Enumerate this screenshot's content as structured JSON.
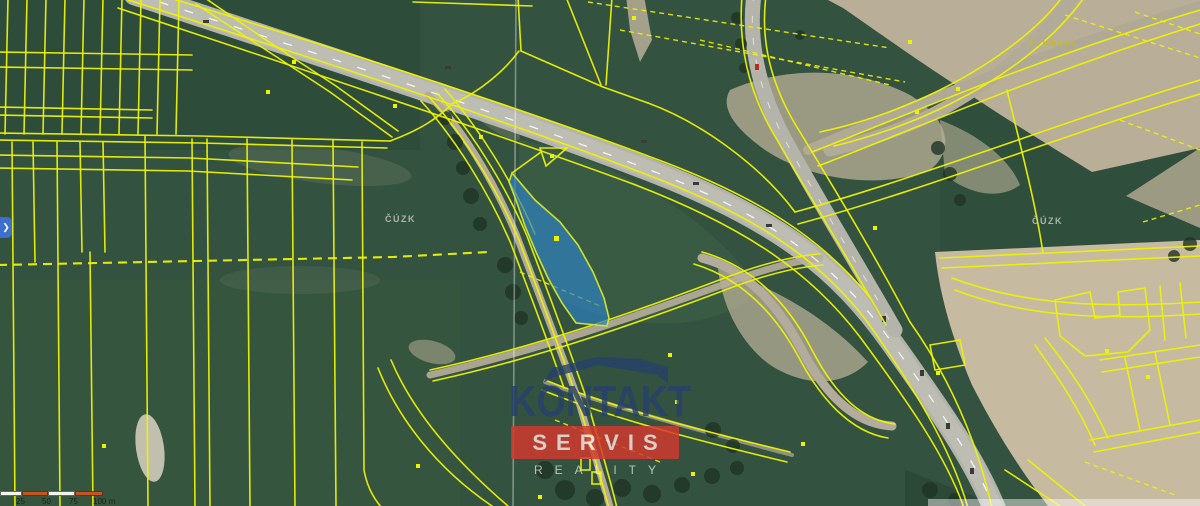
{
  "map": {
    "labels": {
      "cuzk_left": "ČÚZK",
      "cuzk_right": "ČÚZK",
      "place": "Za lukami"
    },
    "watermark": {
      "line1": "KONTAKT",
      "line2": "SERVIS",
      "line3": "REALITY"
    },
    "scalebar": {
      "labels": [
        "25",
        "50",
        "75",
        "100 m"
      ]
    },
    "expand_button": {
      "glyph": "❯"
    }
  },
  "colors": {
    "yellow_line": "#edf203",
    "parcel_fill": "#2e80c1",
    "parcel_stroke": "#cfe32a",
    "watermark_navy": "#27406b",
    "watermark_red": "#d23a2e",
    "scalebar_orange": "#c7541f",
    "scalebar_white": "#f5f5f0",
    "button_blue": "#3c6fd0"
  }
}
